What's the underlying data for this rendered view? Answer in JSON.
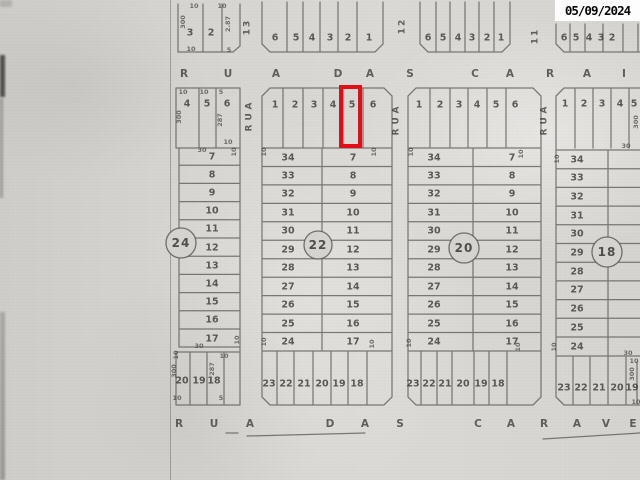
{
  "stamp": {
    "date": "05/09/2024"
  },
  "colors": {
    "highlight": "#e30d18",
    "ink": "#3d3c38",
    "paper": "#d3d1cd"
  },
  "map": {
    "top_street": {
      "name": "RUA DAS CARAI",
      "letters": [
        "R",
        "U",
        "A",
        "D",
        "A",
        "S",
        "C",
        "A",
        "R",
        "A",
        "I"
      ]
    },
    "bottom_street": {
      "name": "RUA DAS CARAVE",
      "letters": [
        "R",
        "U",
        "A",
        "D",
        "A",
        "S",
        "C",
        "A",
        "R",
        "A",
        "V",
        "E"
      ]
    },
    "cross_streets": [
      {
        "number": "13",
        "name": "RUA"
      },
      {
        "number": "12",
        "name": "RUA"
      },
      {
        "number": "11",
        "name": "RUA"
      }
    ],
    "top_strip_blocks": [
      {
        "lots": [
          "3",
          "2"
        ],
        "dims": [
          "10",
          "10",
          "300",
          "2.87",
          "10",
          "5"
        ]
      },
      {
        "lots": [
          "6",
          "5",
          "4",
          "3",
          "2",
          "1"
        ]
      },
      {
        "lots": [
          "6",
          "5",
          "4",
          "3",
          "2",
          "1"
        ]
      },
      {
        "lots": [
          "6",
          "5",
          "4",
          "3",
          "2"
        ]
      }
    ],
    "blocks": [
      {
        "number": "24",
        "top_lots": [
          "4",
          "5",
          "6"
        ],
        "top_dims": [
          "10",
          "10",
          "5",
          "300",
          "287",
          "10"
        ],
        "rows": [
          "7",
          "8",
          "9",
          "10",
          "11",
          "12",
          "13",
          "14",
          "15",
          "16",
          "17"
        ],
        "row_dims": [
          "30",
          "10",
          "30",
          "10"
        ],
        "bottom_lots": [
          "20",
          "19",
          "18"
        ],
        "bottom_dims": [
          "10",
          "300",
          "287",
          "10",
          "10",
          "5"
        ]
      },
      {
        "number": "22",
        "top_lots": [
          "1",
          "2",
          "3",
          "4",
          "5",
          "6"
        ],
        "left_rows": [
          "34",
          "33",
          "32",
          "31",
          "30",
          "29",
          "28",
          "27",
          "26",
          "25",
          "24"
        ],
        "right_rows": [
          "7",
          "8",
          "9",
          "10",
          "11",
          "12",
          "13",
          "14",
          "15",
          "16",
          "17"
        ],
        "bottom_lots": [
          "23",
          "22",
          "21",
          "20",
          "19",
          "18"
        ],
        "corner_dims": [
          "10",
          "10",
          "10",
          "10"
        ]
      },
      {
        "number": "20",
        "top_lots": [
          "1",
          "2",
          "3",
          "4",
          "5",
          "6"
        ],
        "left_rows": [
          "34",
          "33",
          "32",
          "31",
          "30",
          "29",
          "28",
          "27",
          "26",
          "25",
          "24"
        ],
        "right_rows": [
          "7",
          "8",
          "9",
          "10",
          "11",
          "12",
          "13",
          "14",
          "15",
          "16",
          "17"
        ],
        "bottom_lots": [
          "23",
          "22",
          "21",
          "20",
          "19",
          "18"
        ],
        "corner_dims": [
          "10",
          "10",
          "10",
          "10"
        ]
      },
      {
        "number": "18",
        "top_lots": [
          "1",
          "2",
          "3",
          "4",
          "5"
        ],
        "left_rows": [
          "34",
          "33",
          "32",
          "31",
          "30",
          "29",
          "28",
          "27",
          "26",
          "25",
          "24"
        ],
        "bottom_lots": [
          "23",
          "22",
          "21",
          "20",
          "19"
        ],
        "corner_dims": [
          "10",
          "10"
        ],
        "edge_dims": [
          "300",
          "30",
          "30",
          "10",
          "300",
          "10"
        ]
      }
    ],
    "highlight": {
      "block": "22",
      "lot": "5"
    }
  }
}
